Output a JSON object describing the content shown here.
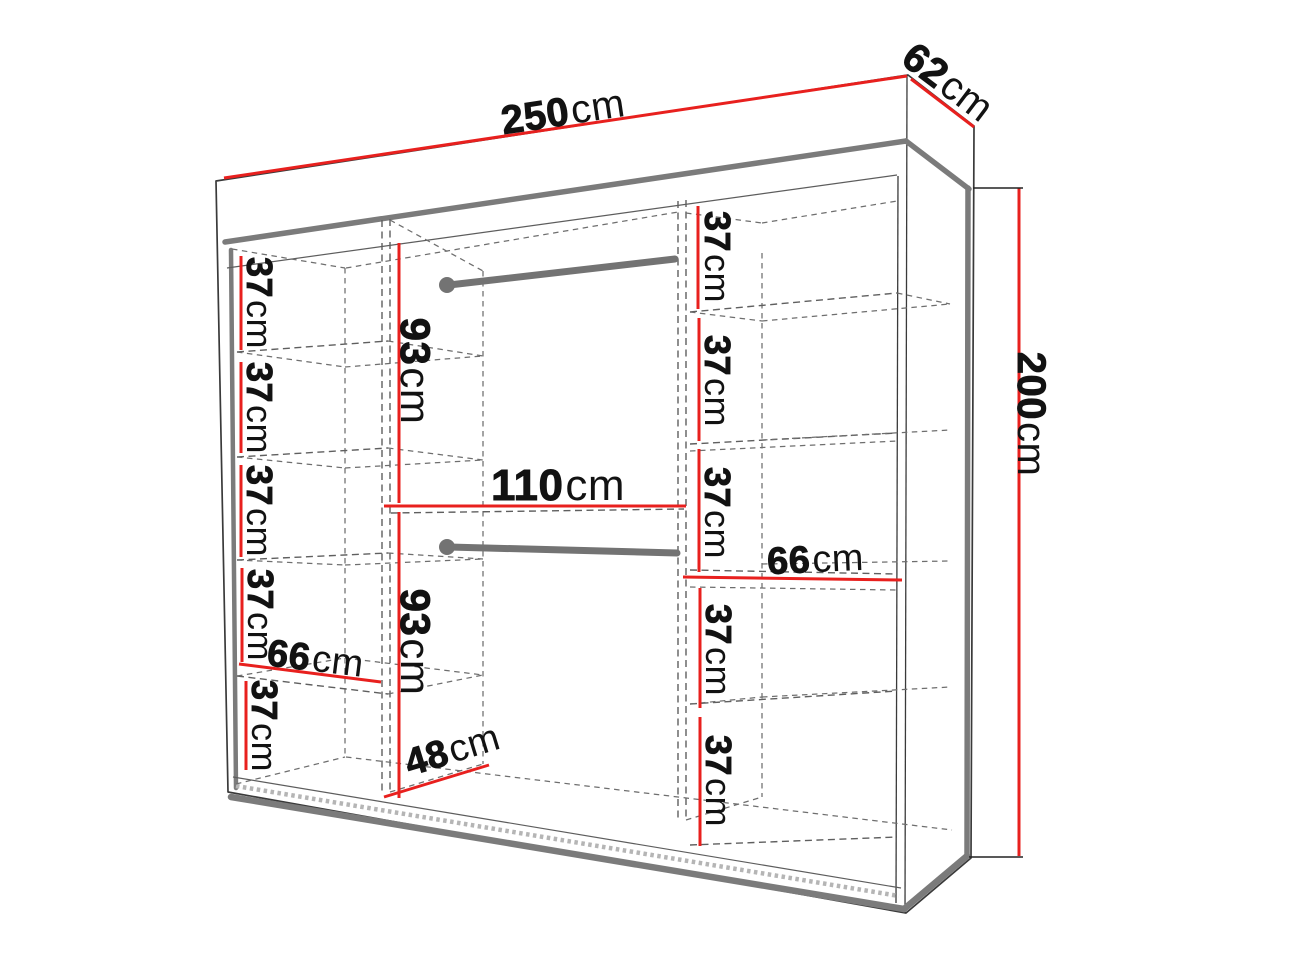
{
  "diagram": {
    "type": "wardrobe-dimension-drawing",
    "overall": {
      "width": {
        "value": "250",
        "unit": "cm"
      },
      "depth": {
        "value": "62",
        "unit": "cm"
      },
      "height": {
        "value": "200",
        "unit": "cm"
      }
    },
    "left_column": {
      "shelves": [
        {
          "value": "37",
          "unit": "cm"
        },
        {
          "value": "37",
          "unit": "cm"
        },
        {
          "value": "37",
          "unit": "cm"
        },
        {
          "value": "37",
          "unit": "cm"
        },
        {
          "value": "37",
          "unit": "cm"
        }
      ],
      "shelf_width": {
        "value": "66",
        "unit": "cm"
      }
    },
    "middle_column": {
      "hanging_top": {
        "value": "93",
        "unit": "cm"
      },
      "width": {
        "value": "110",
        "unit": "cm"
      },
      "hanging_bottom": {
        "value": "93",
        "unit": "cm"
      },
      "floor_depth": {
        "value": "48",
        "unit": "cm"
      }
    },
    "right_column": {
      "shelves_upper": [
        {
          "value": "37",
          "unit": "cm"
        },
        {
          "value": "37",
          "unit": "cm"
        },
        {
          "value": "37",
          "unit": "cm"
        }
      ],
      "shelf_width": {
        "value": "66",
        "unit": "cm"
      },
      "shelves_lower": [
        {
          "value": "37",
          "unit": "cm"
        },
        {
          "value": "37",
          "unit": "cm"
        }
      ]
    },
    "colors": {
      "dimension_red": "#e8201e",
      "frame_gray": "#7b7b7b",
      "rail_gray": "#737373",
      "outline": "#3a3a3a",
      "hidden_line": "#5f5f5f",
      "hatch": "#b5b5b5",
      "label_text": "#121212"
    }
  }
}
